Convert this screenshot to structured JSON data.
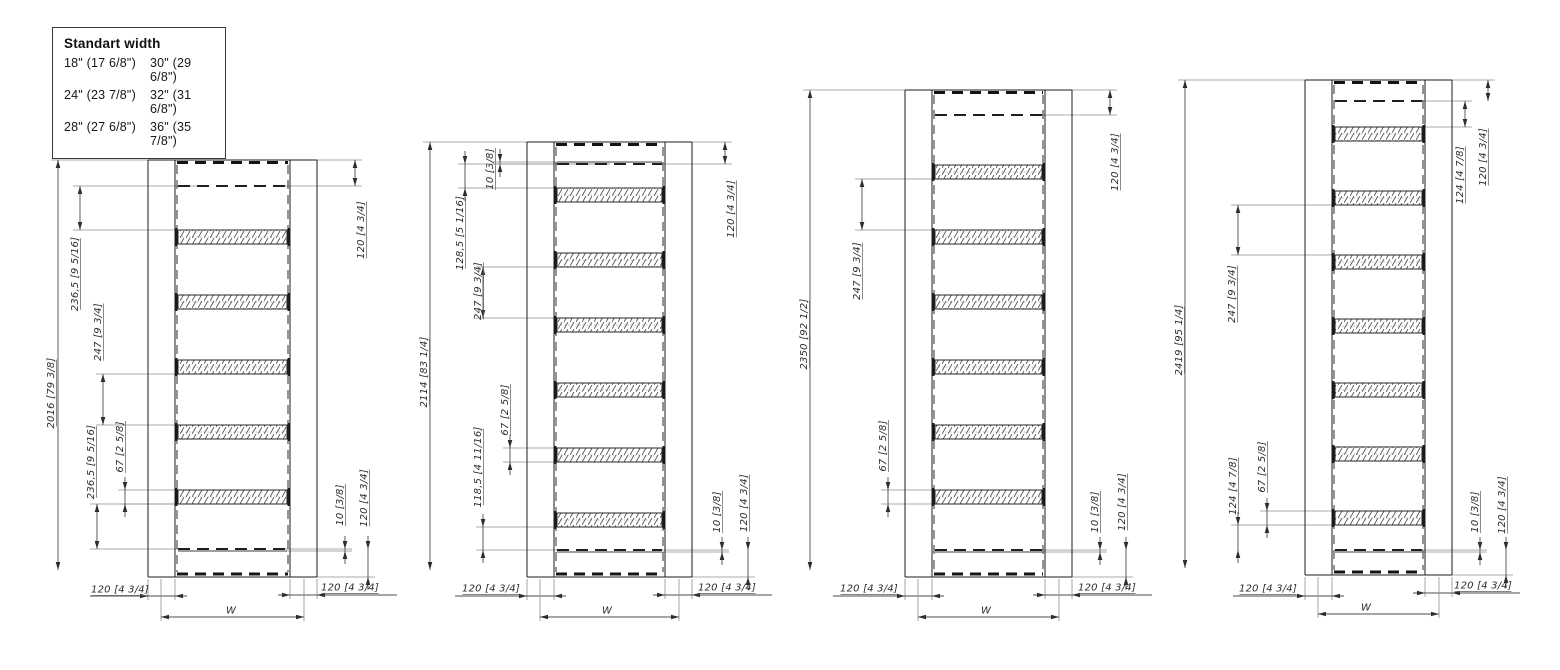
{
  "legend": {
    "title": "Standart width",
    "rows": [
      {
        "col1": "18\" (17 6/8\")",
        "col2": "30\" (29 6/8\")"
      },
      {
        "col1": "24\" (23 7/8\")",
        "col2": "32\" (31 6/8\")"
      },
      {
        "col1": "28\" (27 6/8\")",
        "col2": "36\" (35 7/8\")"
      }
    ]
  },
  "drawings": [
    {
      "id": "height-2016",
      "rung_count": 5,
      "dims": [
        {
          "name": "overall-height",
          "label": "2016 [79 3/8]"
        },
        {
          "name": "top-gap",
          "label": "236,5 [9 5/16]"
        },
        {
          "name": "rung-gap",
          "label": "247 [9 3/4]"
        },
        {
          "name": "bottom-gap",
          "label": "236,5 [9 5/16]"
        },
        {
          "name": "rung-height",
          "label": "67 [2 5/8]"
        },
        {
          "name": "top-right-offset",
          "label": "120 [4 3/4]"
        },
        {
          "name": "hidden-line-offset",
          "label": "10 [3/8]"
        },
        {
          "name": "bottom-right-offset",
          "label": "120 [4 3/4]"
        },
        {
          "name": "left-rail-width",
          "label": "120 [4 3/4]"
        },
        {
          "name": "right-rail-width",
          "label": "120 [4 3/4]"
        },
        {
          "name": "overall-width",
          "label": "W"
        }
      ]
    },
    {
      "id": "height-2114",
      "rung_count": 6,
      "dims": [
        {
          "name": "overall-height",
          "label": "2114 [83 1/4]"
        },
        {
          "name": "top-hidden-offset",
          "label": "10 [3/8]"
        },
        {
          "name": "top-gap",
          "label": "128,5 [5 1/16]"
        },
        {
          "name": "rung-gap",
          "label": "247 [9 3/4]"
        },
        {
          "name": "rung-height",
          "label": "67 [2 5/8]"
        },
        {
          "name": "bottom-gap",
          "label": "118,5 [4 11/16]"
        },
        {
          "name": "top-right-offset",
          "label": "120 [4 3/4]"
        },
        {
          "name": "hidden-line-offset",
          "label": "10 [3/8]"
        },
        {
          "name": "bottom-right-offset",
          "label": "120 [4 3/4]"
        },
        {
          "name": "left-rail-width",
          "label": "120 [4 3/4]"
        },
        {
          "name": "right-rail-width",
          "label": "120 [4 3/4]"
        },
        {
          "name": "overall-width",
          "label": "W"
        }
      ]
    },
    {
      "id": "height-2350",
      "rung_count": 6,
      "dims": [
        {
          "name": "overall-height",
          "label": "2350 [92 1/2]"
        },
        {
          "name": "rung-gap",
          "label": "247 [9 3/4]"
        },
        {
          "name": "rung-height",
          "label": "67 [2 5/8]"
        },
        {
          "name": "top-right-offset",
          "label": "120 [4 3/4]"
        },
        {
          "name": "hidden-line-offset",
          "label": "10 [3/8]"
        },
        {
          "name": "bottom-right-offset",
          "label": "120 [4 3/4]"
        },
        {
          "name": "left-rail-width",
          "label": "120 [4 3/4]"
        },
        {
          "name": "right-rail-width",
          "label": "120 [4 3/4]"
        },
        {
          "name": "overall-width",
          "label": "W"
        }
      ]
    },
    {
      "id": "height-2419",
      "rung_count": 7,
      "dims": [
        {
          "name": "overall-height",
          "label": "2419 [95 1/4]"
        },
        {
          "name": "rung-gap",
          "label": "247 [9 3/4]"
        },
        {
          "name": "bottom-gap",
          "label": "124 [4 7/8]"
        },
        {
          "name": "rung-height",
          "label": "67 [2 5/8]"
        },
        {
          "name": "top-gap",
          "label": "124 [4 7/8]"
        },
        {
          "name": "top-right-offset",
          "label": "120 [4 3/4]"
        },
        {
          "name": "hidden-line-offset",
          "label": "10 [3/8]"
        },
        {
          "name": "bottom-right-offset",
          "label": "120 [4 3/4]"
        },
        {
          "name": "left-rail-width",
          "label": "120 [4 3/4]"
        },
        {
          "name": "right-rail-width",
          "label": "120 [4 3/4]"
        },
        {
          "name": "overall-width",
          "label": "W"
        }
      ]
    }
  ]
}
